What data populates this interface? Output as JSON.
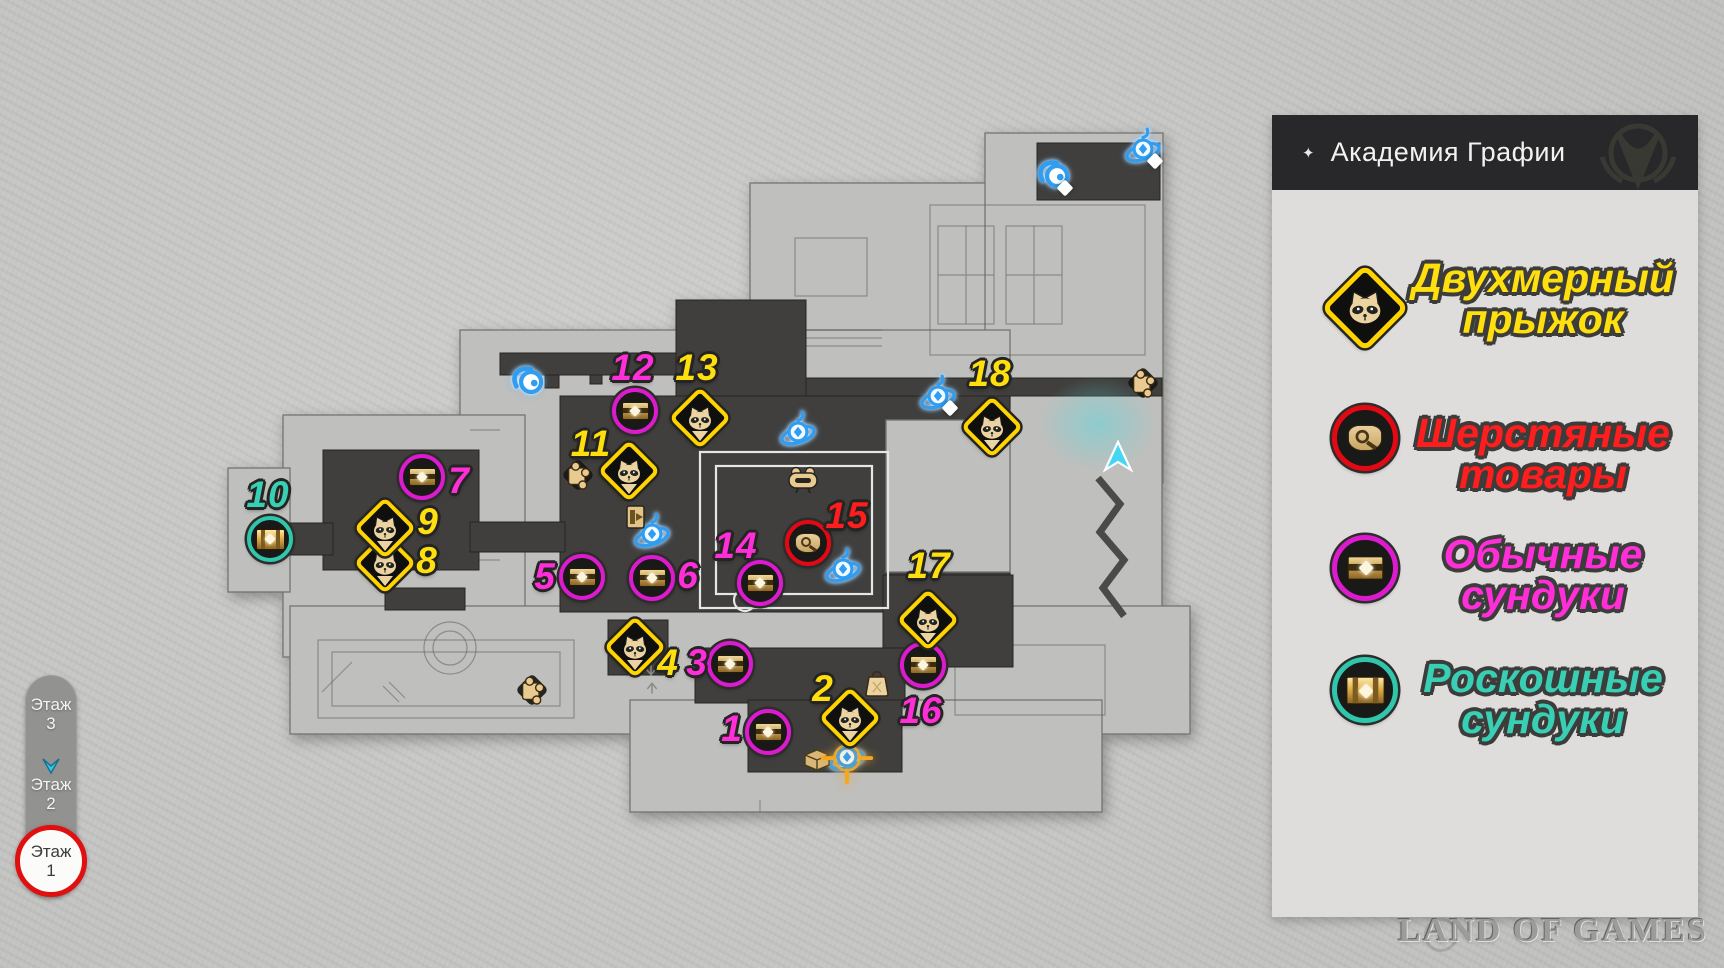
{
  "legend": {
    "title": "Академия Графии",
    "title_icon": "four-point-star",
    "items": [
      {
        "type": "jump",
        "line1": "Двухмерный",
        "line2": "прыжок",
        "text_color": "#ffdf0e",
        "icon": "raccoon-diamond"
      },
      {
        "type": "wool",
        "line1": "Шерстяные",
        "line2": "товары",
        "text_color": "#ff1d1d",
        "icon": "wool-pouch-red-circle"
      },
      {
        "type": "chest",
        "line1": "Обычные",
        "line2": "сундуки",
        "text_color": "#ff2ed8",
        "icon": "chest-magenta-circle"
      },
      {
        "type": "luxury",
        "line1": "Роскошные",
        "line2": "сундуки",
        "text_color": "#38cfb4",
        "icon": "luxury-chest-teal-circle"
      }
    ]
  },
  "floor_selector": {
    "floors": [
      {
        "name": "Этаж",
        "num": "3",
        "active": false
      },
      {
        "name": "Этаж",
        "num": "2",
        "active": false
      },
      {
        "name": "Этаж",
        "num": "1",
        "active": true,
        "annotation": "red-circle"
      }
    ]
  },
  "map": {
    "markers": [
      {
        "num": "1",
        "type": "chest",
        "x": 768,
        "y": 732,
        "lx": 732,
        "ly": 729
      },
      {
        "num": "2",
        "type": "jump",
        "x": 850,
        "y": 718,
        "lx": 823,
        "ly": 689
      },
      {
        "num": "3",
        "type": "chest",
        "x": 730,
        "y": 664,
        "lx": 697,
        "ly": 663
      },
      {
        "num": "4",
        "type": "jump",
        "x": 635,
        "y": 647,
        "lx": 668,
        "ly": 663
      },
      {
        "num": "5",
        "type": "chest",
        "x": 582,
        "y": 577,
        "lx": 545,
        "ly": 577
      },
      {
        "num": "6",
        "type": "chest",
        "x": 652,
        "y": 578,
        "lx": 688,
        "ly": 576
      },
      {
        "num": "7",
        "type": "chest",
        "x": 422,
        "y": 477,
        "lx": 459,
        "ly": 481
      },
      {
        "num": "8",
        "type": "jump",
        "x": 385,
        "y": 563,
        "lx": 427,
        "ly": 561
      },
      {
        "num": "9",
        "type": "jump",
        "x": 385,
        "y": 528,
        "lx": 428,
        "ly": 522
      },
      {
        "num": "10",
        "type": "luxury",
        "x": 270,
        "y": 539,
        "lx": 268,
        "ly": 495
      },
      {
        "num": "11",
        "type": "jump",
        "x": 629,
        "y": 471,
        "lx": 591,
        "ly": 444
      },
      {
        "num": "12",
        "type": "chest",
        "x": 635,
        "y": 411,
        "lx": 633,
        "ly": 368
      },
      {
        "num": "13",
        "type": "jump",
        "x": 700,
        "y": 418,
        "lx": 697,
        "ly": 368
      },
      {
        "num": "14",
        "type": "chest",
        "x": 760,
        "y": 583,
        "lx": 736,
        "ly": 546
      },
      {
        "num": "15",
        "type": "wool",
        "x": 808,
        "y": 543,
        "lx": 847,
        "ly": 516
      },
      {
        "num": "16",
        "type": "chest",
        "x": 923,
        "y": 665,
        "lx": 921,
        "ly": 711
      },
      {
        "num": "17",
        "type": "jump",
        "x": 928,
        "y": 620,
        "lx": 929,
        "ly": 566
      },
      {
        "num": "18",
        "type": "jump",
        "x": 992,
        "y": 427,
        "lx": 990,
        "ly": 374
      }
    ],
    "poi": [
      {
        "type": "portal-glow",
        "x": 1098,
        "y": 424
      },
      {
        "type": "origami-bird",
        "x": 529,
        "y": 382
      },
      {
        "type": "origami-bird",
        "x": 1055,
        "y": 176
      },
      {
        "type": "space-anchor",
        "x": 652,
        "y": 535
      },
      {
        "type": "space-anchor",
        "x": 798,
        "y": 433
      },
      {
        "type": "space-anchor",
        "x": 843,
        "y": 570
      },
      {
        "type": "space-anchor",
        "x": 938,
        "y": 397
      },
      {
        "type": "space-anchor",
        "x": 1143,
        "y": 150
      },
      {
        "type": "space-anchor",
        "x": 847,
        "y": 758
      },
      {
        "type": "sparkle",
        "x": 950,
        "y": 408
      },
      {
        "type": "sparkle",
        "x": 1065,
        "y": 188
      },
      {
        "type": "sparkle",
        "x": 1155,
        "y": 161
      },
      {
        "type": "puzzle-piece",
        "x": 578,
        "y": 475
      },
      {
        "type": "puzzle-piece",
        "x": 532,
        "y": 690
      },
      {
        "type": "puzzle-piece",
        "x": 1143,
        "y": 383
      },
      {
        "type": "exit-sign",
        "x": 637,
        "y": 517
      },
      {
        "type": "warp-trotter",
        "x": 803,
        "y": 480
      },
      {
        "type": "shop-bag",
        "x": 877,
        "y": 682
      },
      {
        "type": "treasure-chest",
        "x": 817,
        "y": 758
      },
      {
        "type": "target-crosshair",
        "x": 847,
        "y": 758
      },
      {
        "type": "player-arrow",
        "x": 1118,
        "y": 457
      },
      {
        "type": "stairs-up-arrow",
        "x": 652,
        "y": 688
      },
      {
        "type": "stairs-down-arrow",
        "x": 651,
        "y": 670
      }
    ]
  },
  "colors": {
    "jump_ring": "#ffd400",
    "jump_label": "#ffdf0e",
    "chest_ring": "#dd1bce",
    "chest_label": "#ff2ed8",
    "wool_ring": "#e30914",
    "wool_label": "#ff1d1d",
    "luxury_ring": "#2fc6ab",
    "luxury_label": "#38cfb4",
    "annotation_red": "#e01010",
    "player_cyan": "#45d6f4",
    "crosshair_orange": "#f5a81e",
    "panel_bg": "#dedddb",
    "header_bg": "#28282a"
  },
  "watermark": {
    "text": "LAND OF GAMES"
  }
}
